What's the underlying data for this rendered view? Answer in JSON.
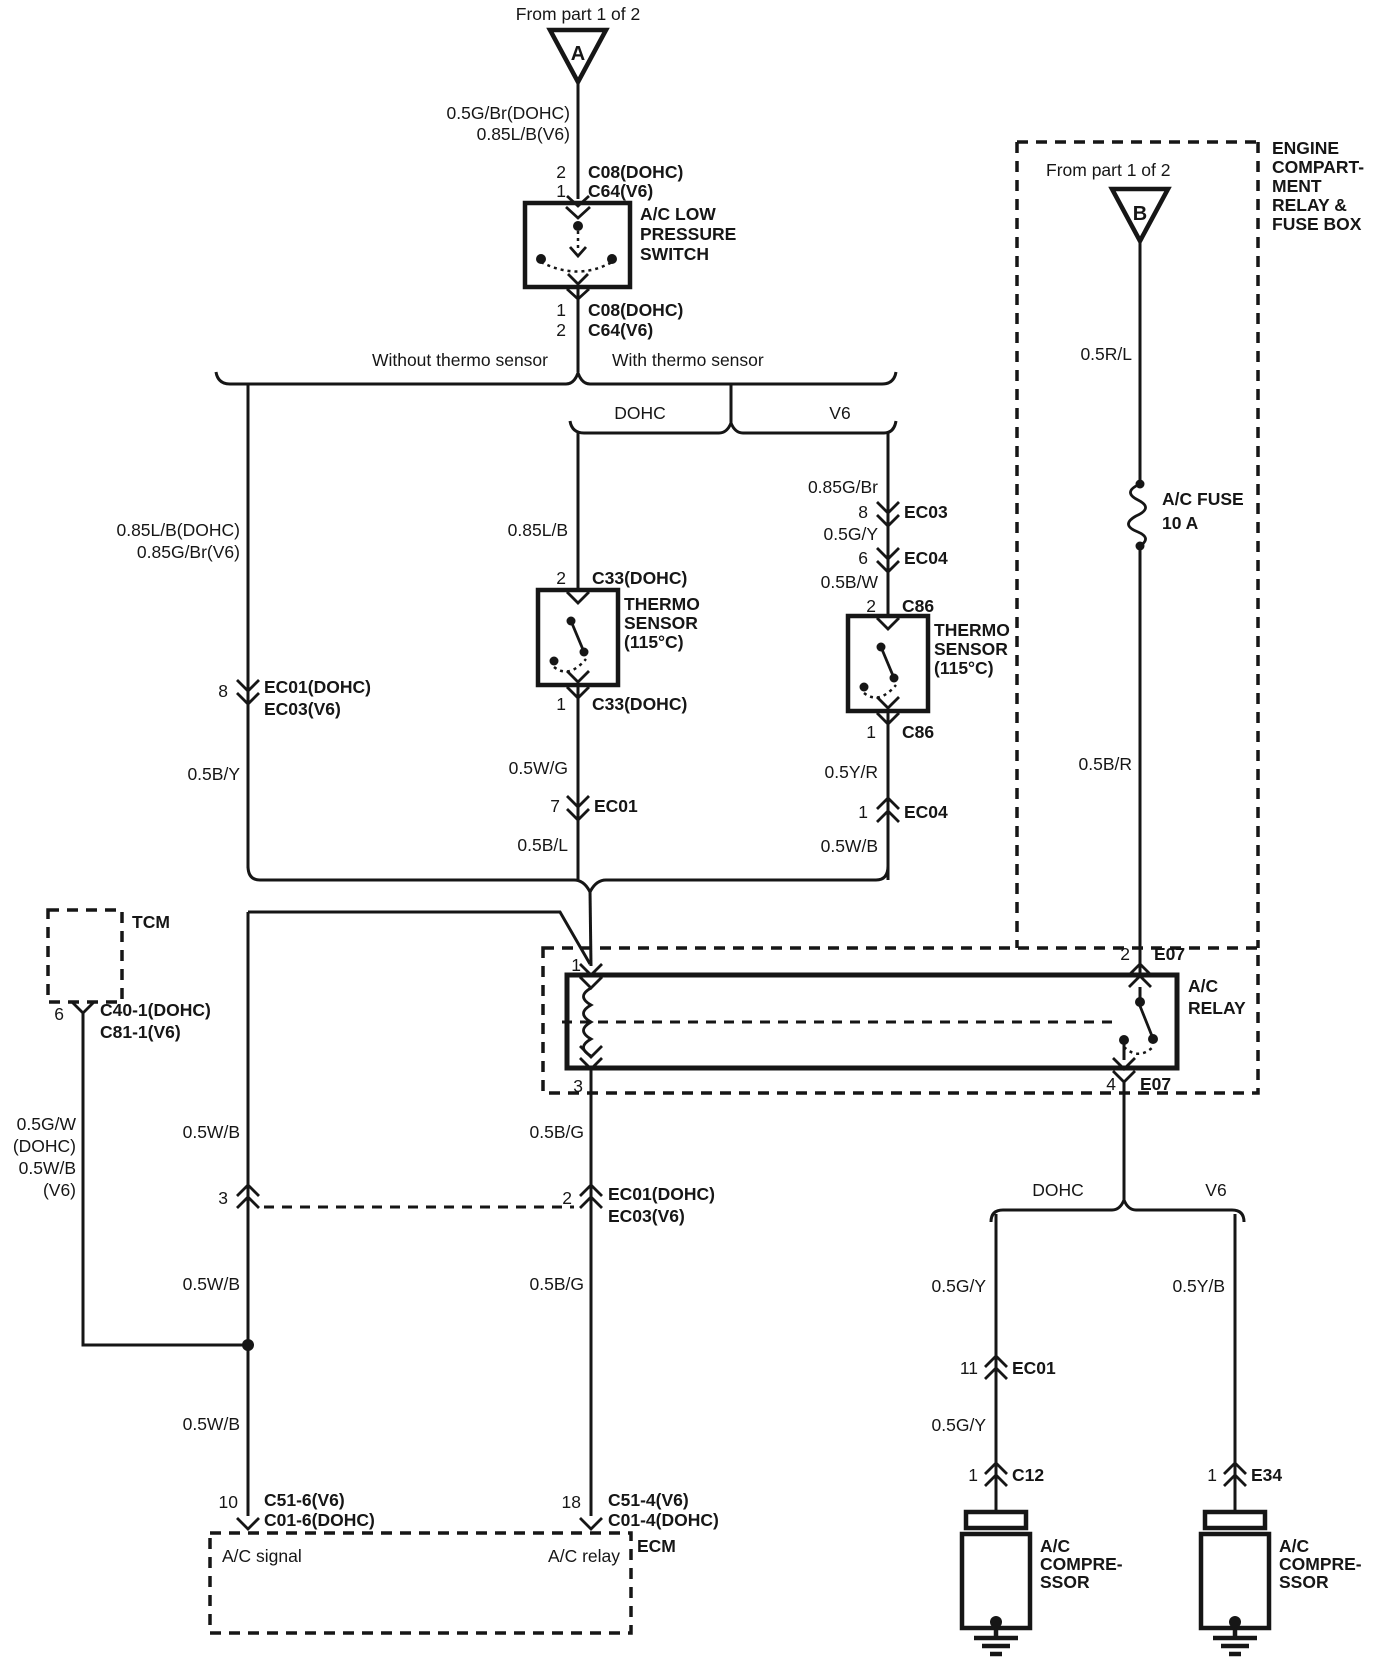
{
  "colors": {
    "ink": "#161616",
    "paper": "#ffffff"
  },
  "source_a": {
    "from_label": "From part 1 of 2",
    "marker": "A"
  },
  "pressure_switch": {
    "wire_top": [
      "0.5G/Br(DOHC)",
      "0.85L/B(V6)"
    ],
    "conn_top": [
      {
        "pin": "2",
        "name": "C08(DOHC)"
      },
      {
        "pin": "1",
        "name": "C64(V6)"
      }
    ],
    "name_lines": [
      "A/C LOW",
      "PRESSURE",
      "SWITCH"
    ],
    "conn_bottom": [
      {
        "pin": "1",
        "name": "C08(DOHC)"
      },
      {
        "pin": "2",
        "name": "C64(V6)"
      }
    ]
  },
  "branching": {
    "without": "Without thermo sensor",
    "with": "With thermo sensor",
    "dohc": "DOHC",
    "v6": "V6"
  },
  "no_sensor_branch": {
    "wire1": [
      "0.85L/B(DOHC)",
      "0.85G/Br(V6)"
    ],
    "conn": {
      "pin": "8",
      "names": [
        "EC01(DOHC)",
        "EC03(V6)"
      ]
    },
    "wire2": "0.5B/Y"
  },
  "dohc_sensor_branch": {
    "wire1": "0.85L/B",
    "conn_top": {
      "pin": "2",
      "name": "C33(DOHC)"
    },
    "sensor_lines": [
      "THERMO",
      "SENSOR",
      "(115°C)"
    ],
    "conn_bottom": {
      "pin": "1",
      "name": "C33(DOHC)"
    },
    "wire2": "0.5W/G",
    "conn2": {
      "pin": "7",
      "name": "EC01"
    },
    "wire3": "0.5B/L"
  },
  "v6_sensor_branch": {
    "wire1": "0.85G/Br",
    "conn1": {
      "pin": "8",
      "name": "EC03"
    },
    "wire2": "0.5G/Y",
    "conn2": {
      "pin": "6",
      "name": "EC04"
    },
    "wire3": "0.5B/W",
    "conn_top": {
      "pin": "2",
      "name": "C86"
    },
    "sensor_lines": [
      "THERMO",
      "SENSOR",
      "(115°C)"
    ],
    "conn_bottom": {
      "pin": "1",
      "name": "C86"
    },
    "wire4": "0.5Y/R",
    "conn3": {
      "pin": "1",
      "name": "EC04"
    },
    "wire5": "0.5W/B"
  },
  "fuse_box": {
    "label_lines": [
      "ENGINE",
      "COMPART-",
      "MENT",
      "RELAY &",
      "FUSE BOX"
    ],
    "from_label": "From part 1 of 2",
    "marker": "B",
    "wire1": "0.5R/L",
    "fuse_lines": [
      "A/C FUSE",
      "10 A"
    ],
    "wire2": "0.5B/R"
  },
  "relay": {
    "name_lines": [
      "A/C",
      "RELAY"
    ],
    "pin1": "1",
    "pin3": "3",
    "pin2": {
      "pin": "2",
      "name": "E07"
    },
    "pin4": {
      "pin": "4",
      "name": "E07"
    }
  },
  "tcm": {
    "name": "TCM",
    "conn": {
      "pin": "6",
      "names": [
        "C40-1(DOHC)",
        "C81-1(V6)"
      ]
    },
    "wire_lines": [
      "0.5G/W",
      "(DOHC)",
      "0.5W/B",
      "(V6)"
    ]
  },
  "signal_path": {
    "wire1": "0.5W/B",
    "conn": "3",
    "wire2": "0.5W/B",
    "wire3": "0.5W/B",
    "ecm_conn": {
      "pin": "10",
      "names": [
        "C51-6(V6)",
        "C01-6(DOHC)"
      ]
    }
  },
  "relay_path": {
    "wire1": "0.5B/G",
    "conn": {
      "pin": "2",
      "names": [
        "EC01(DOHC)",
        "EC03(V6)"
      ]
    },
    "wire2": "0.5B/G",
    "ecm_conn": {
      "pin": "18",
      "names": [
        "C51-4(V6)",
        "C01-4(DOHC)"
      ]
    }
  },
  "ecm": {
    "name": "ECM",
    "signal_label": "A/C signal",
    "relay_label": "A/C relay"
  },
  "compressor_split": {
    "dohc": "DOHC",
    "v6": "V6"
  },
  "dohc_compressor": {
    "wire1": "0.5G/Y",
    "conn1": {
      "pin": "11",
      "name": "EC01"
    },
    "wire2": "0.5G/Y",
    "conn2": {
      "pin": "1",
      "name": "C12"
    },
    "name_lines": [
      "A/C",
      "COMPRE-",
      "SSOR"
    ]
  },
  "v6_compressor": {
    "wire1": "0.5Y/B",
    "conn2": {
      "pin": "1",
      "name": "E34"
    },
    "name_lines": [
      "A/C",
      "COMPRE-",
      "SSOR"
    ]
  }
}
